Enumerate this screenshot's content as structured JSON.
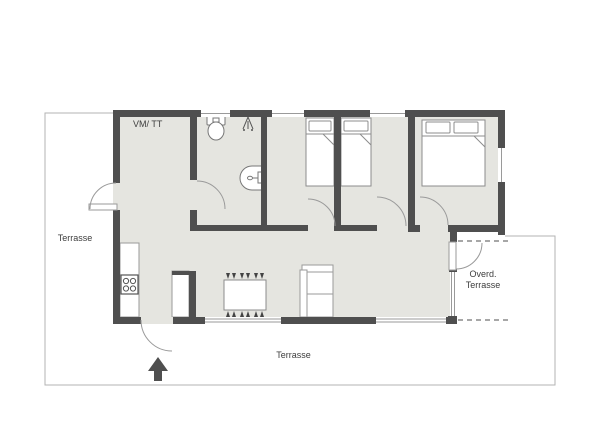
{
  "plan": {
    "rooms": {
      "utility_label": "VM/ TT"
    },
    "terrace": {
      "left_label": "Terrasse",
      "bottom_label": "Terrasse",
      "covered_line1": "Overd.",
      "covered_line2": "Terrasse"
    },
    "colors": {
      "background": "#ffffff",
      "floor": "#e5e5e0",
      "wall": "#4f4f4f",
      "terrace_outline": "#b3b3b3",
      "roof_overhang_dash": "#8a8a8a",
      "furniture_line": "#8c8c8c",
      "label_text": "#3d3d3d"
    },
    "icons": {
      "toilet": "toilet-icon",
      "shower": "shower-icon",
      "washbasin": "washbasin-icon",
      "single_bed": "single-bed-icon",
      "double_bed": "double-bed-icon",
      "kitchen_counter": "kitchen-counter",
      "stove": "stove-icon",
      "tall_cabinet": "tall-cabinet",
      "dining_table": "dining-table",
      "stool": "stool-icon",
      "sofa": "sofa-icon",
      "entrance_arrow": "entrance-arrow-icon"
    }
  }
}
